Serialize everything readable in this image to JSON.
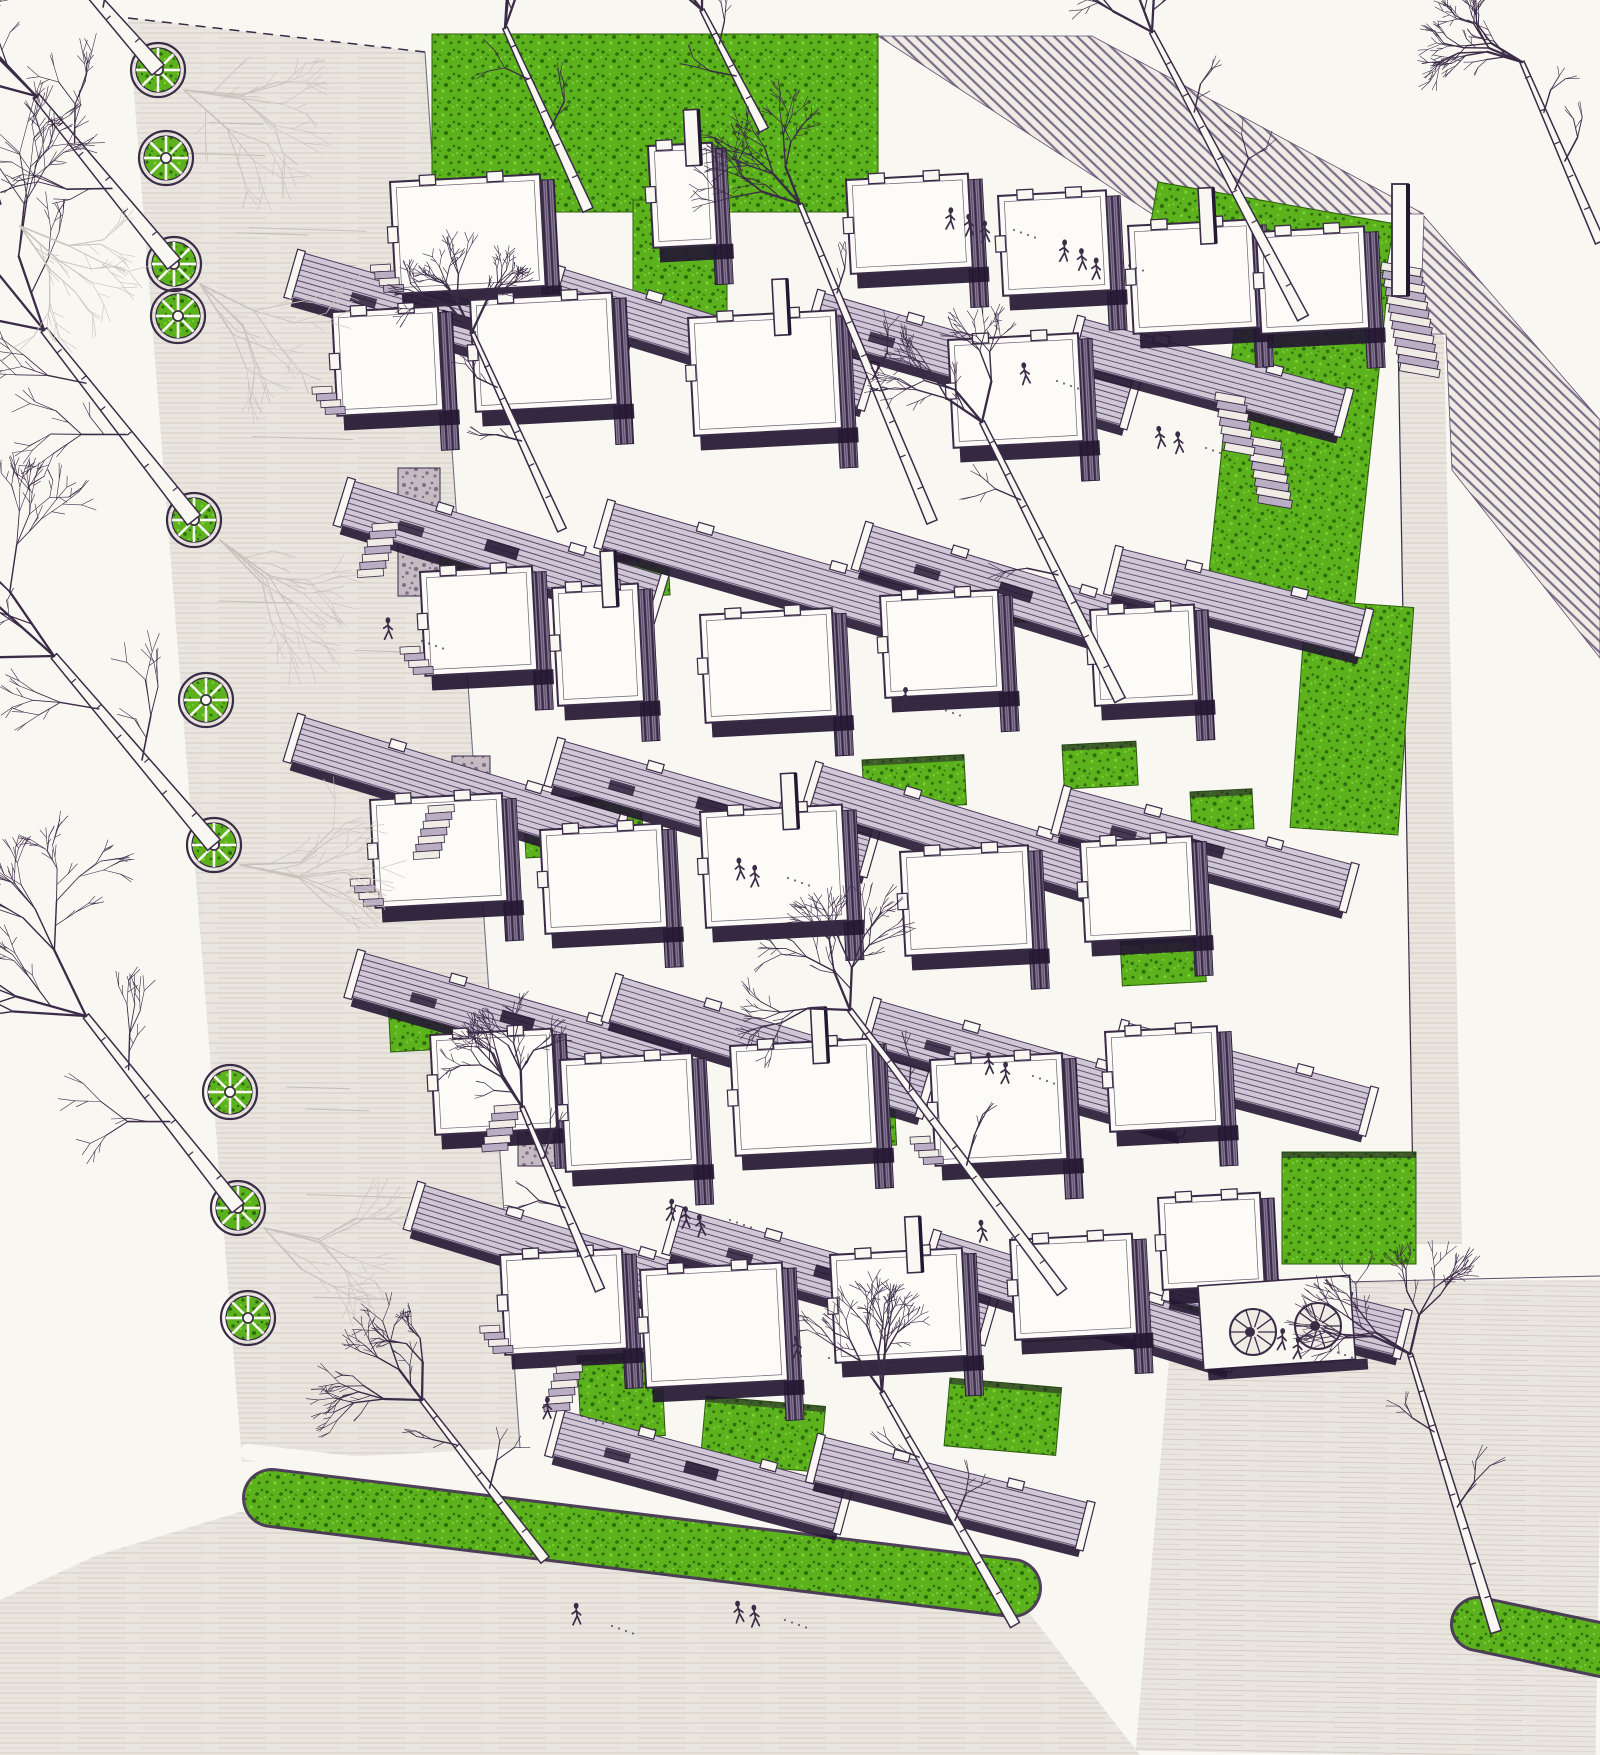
{
  "artwork": {
    "aria_label": "Pen-and-ink axonometric architectural rendering of a terraced courtyard housing estate: staggered white-roofed dwelling modules linked by hatched walkway roofs, bright green lawns and courtyard gardens, a tree-lined street with circular planters on the left, stairs descending a green slope on the right, and a curved grass verge along the bottom street.",
    "medium": "hand-drawn ink rendering with green wash",
    "visible_text": ""
  },
  "palette": {
    "paper": "#f9f7f2",
    "ink": "#3a2b47",
    "ink_soft": "#5d4b6b",
    "shadow": "#231732",
    "pavement": "#e9e6e0",
    "pavement_line": "#d4cec4",
    "pavement_accent": "#b9b0a6",
    "grass": "#5cb21c",
    "grass_dark": "#2e6a0b",
    "grass_light": "#7ed334",
    "grass_edge": "#2f5d10",
    "wall_base": "#8d7f9b",
    "walk_base": "#cfc6d6",
    "walk_line": "#4a3959",
    "stone": "#c6bbc3",
    "stone_dark": "#6b5c72",
    "hatch_bg": "#efece6",
    "hatch_line": "#7b6c88",
    "tree_pale": "#c9c2ba"
  },
  "scene": {
    "road_poly": [
      128,
      18,
      425,
      52,
      520,
      1448,
      242,
      1462
    ],
    "road_dash_edge": [
      128,
      18,
      425,
      52
    ],
    "bottom_pav_poly": [
      0,
      1755,
      0,
      1600,
      95,
      1556,
      240,
      1512,
      1030,
      1614,
      1140,
      1755
    ],
    "plaza_poly": [
      1140,
      1755,
      1168,
      1344,
      1260,
      1284,
      1600,
      1276,
      1600,
      1755
    ],
    "east_strip_poly": [
      1398,
      334,
      1444,
      334,
      1462,
      1244,
      1414,
      1244
    ],
    "hatch_top_poly": [
      878,
      36,
      1092,
      36,
      1424,
      214,
      1152,
      214
    ],
    "hatch_corner_poly": [
      1424,
      216,
      1600,
      420,
      1600,
      658,
      1452,
      470,
      1446,
      334,
      1420,
      334
    ],
    "greens": [
      [
        432,
        34,
        446,
        178,
        0,
        0
      ],
      [
        633,
        200,
        94,
        140,
        0,
        0
      ],
      [
        1158,
        182,
        240,
        72,
        10,
        0
      ],
      [
        1242,
        258,
        148,
        336,
        6,
        0
      ],
      [
        1306,
        600,
        108,
        228,
        4,
        0
      ],
      [
        420,
        550,
        128,
        46,
        -3,
        1
      ],
      [
        572,
        558,
        96,
        42,
        -3,
        1
      ],
      [
        962,
        585,
        72,
        40,
        -3,
        1
      ],
      [
        523,
        800,
        118,
        58,
        -3,
        1
      ],
      [
        862,
        760,
        102,
        50,
        -3,
        1
      ],
      [
        1062,
        745,
        74,
        44,
        -3,
        1
      ],
      [
        1190,
        792,
        62,
        40,
        -3,
        1
      ],
      [
        388,
        1000,
        94,
        52,
        -3,
        1
      ],
      [
        800,
        1098,
        94,
        52,
        -3,
        1
      ],
      [
        1120,
        940,
        84,
        46,
        -3,
        1
      ],
      [
        577,
        1356,
        84,
        84,
        -3,
        1
      ],
      [
        706,
        1396,
        120,
        66,
        5,
        1
      ],
      [
        950,
        1378,
        112,
        68,
        5,
        1
      ],
      [
        1282,
        1152,
        134,
        112,
        0,
        1
      ],
      [
        1022,
        1300,
        120,
        42,
        -3,
        1
      ],
      [
        1178,
        1298,
        150,
        44,
        -4,
        0
      ]
    ],
    "verge_main": [
      272,
      1498,
      1012,
      1588,
      54
    ],
    "verge_sidewalk": [
      248,
      1452,
      1046,
      1545,
      16
    ],
    "verge_right": [
      1478,
      1624,
      1612,
      1652,
      50
    ],
    "stones": [
      [
        398,
        468,
        42,
        128
      ],
      [
        452,
        756,
        38,
        108
      ],
      [
        518,
        1058,
        38,
        108
      ]
    ],
    "walkways": [
      [
        300,
        252,
        340,
        16,
        1
      ],
      [
        560,
        268,
        330,
        17,
        0
      ],
      [
        820,
        292,
        330,
        16,
        1
      ],
      [
        1080,
        318,
        280,
        15,
        0
      ],
      [
        350,
        480,
        330,
        17,
        1
      ],
      [
        610,
        502,
        330,
        16,
        0
      ],
      [
        868,
        524,
        320,
        17,
        1
      ],
      [
        1118,
        548,
        260,
        14,
        0
      ],
      [
        300,
        716,
        340,
        17,
        0
      ],
      [
        560,
        740,
        330,
        16,
        1
      ],
      [
        818,
        764,
        330,
        17,
        0
      ],
      [
        1066,
        788,
        300,
        15,
        1
      ],
      [
        360,
        952,
        340,
        16,
        1
      ],
      [
        618,
        976,
        330,
        17,
        0
      ],
      [
        876,
        1000,
        330,
        16,
        1
      ],
      [
        1124,
        1022,
        260,
        15,
        0
      ],
      [
        420,
        1184,
        330,
        17,
        0
      ],
      [
        678,
        1208,
        330,
        16,
        1
      ],
      [
        936,
        1232,
        320,
        17,
        0
      ],
      [
        1176,
        1254,
        240,
        14,
        0
      ],
      [
        560,
        1410,
        300,
        15,
        1
      ],
      [
        820,
        1436,
        280,
        14,
        0
      ]
    ],
    "modules": [
      [
        390,
        182,
        150,
        112,
        0,
        1
      ],
      [
        648,
        146,
        64,
        102,
        1,
        0
      ],
      [
        846,
        180,
        122,
        94,
        0,
        0
      ],
      [
        998,
        196,
        108,
        100,
        0,
        0
      ],
      [
        1128,
        226,
        124,
        108,
        1,
        0
      ],
      [
        332,
        312,
        106,
        104,
        0,
        1
      ],
      [
        470,
        300,
        142,
        112,
        0,
        0
      ],
      [
        688,
        318,
        148,
        118,
        1,
        0
      ],
      [
        948,
        340,
        130,
        108,
        0,
        0
      ],
      [
        1256,
        232,
        108,
        102,
        0,
        0
      ],
      [
        420,
        572,
        112,
        104,
        0,
        1
      ],
      [
        552,
        588,
        86,
        118,
        1,
        0
      ],
      [
        700,
        615,
        132,
        108,
        0,
        0
      ],
      [
        880,
        596,
        118,
        102,
        0,
        0
      ],
      [
        1090,
        610,
        104,
        96,
        0,
        0
      ],
      [
        370,
        800,
        132,
        108,
        0,
        1
      ],
      [
        540,
        830,
        122,
        104,
        0,
        0
      ],
      [
        700,
        812,
        142,
        116,
        1,
        0
      ],
      [
        900,
        852,
        128,
        104,
        0,
        0
      ],
      [
        1080,
        842,
        112,
        100,
        0,
        0
      ],
      [
        430,
        1035,
        122,
        100,
        0,
        0
      ],
      [
        560,
        1060,
        132,
        112,
        0,
        0
      ],
      [
        730,
        1046,
        142,
        110,
        1,
        0
      ],
      [
        930,
        1060,
        132,
        106,
        0,
        1
      ],
      [
        1105,
        1032,
        112,
        100,
        0,
        0
      ],
      [
        500,
        1255,
        122,
        100,
        0,
        1
      ],
      [
        640,
        1270,
        142,
        118,
        0,
        0
      ],
      [
        830,
        1255,
        132,
        108,
        1,
        0
      ],
      [
        1010,
        1240,
        122,
        100,
        0,
        0
      ],
      [
        1158,
        1198,
        102,
        92,
        0,
        0
      ]
    ],
    "se_tile": [
      1198,
      1286,
      152,
      84
    ],
    "se_circles": [
      [
        1253,
        1332
      ],
      [
        1318,
        1326
      ]
    ],
    "west_stairs": [
      [
        372,
        524,
        7
      ],
      [
        428,
        806,
        7
      ],
      [
        494,
        1106,
        6
      ],
      [
        556,
        1366,
        6
      ]
    ],
    "right_stairs": [
      [
        1382,
        262,
        13,
        40
      ],
      [
        1248,
        436,
        8,
        34
      ],
      [
        1216,
        392,
        7,
        30
      ]
    ],
    "fins": [
      [
        1392,
        184,
        16,
        112
      ]
    ],
    "planters": [
      [
        158,
        70
      ],
      [
        166,
        158
      ],
      [
        174,
        264
      ],
      [
        178,
        316
      ],
      [
        194,
        520
      ],
      [
        206,
        700
      ],
      [
        214,
        845
      ],
      [
        230,
        1092
      ],
      [
        238,
        1208
      ],
      [
        248,
        1318
      ]
    ],
    "figures": [
      [
        952,
        222,
        3
      ],
      [
        1060,
        255,
        3
      ],
      [
        1023,
        373,
        1
      ],
      [
        1158,
        440,
        2
      ],
      [
        388,
        633,
        1
      ],
      [
        668,
        1212,
        3
      ],
      [
        985,
        1068,
        2
      ],
      [
        978,
        1230,
        1
      ],
      [
        578,
        1618,
        1
      ],
      [
        737,
        1612,
        2
      ],
      [
        1283,
        1342,
        2
      ],
      [
        548,
        1408,
        1
      ],
      [
        795,
        1350,
        1
      ],
      [
        740,
        870,
        2
      ],
      [
        905,
        700,
        1
      ]
    ],
    "trees": [
      [
        158,
        70,
        36,
        -70,
        1.45,
        101,
        1
      ],
      [
        174,
        264,
        36,
        96,
        1.5,
        103,
        1
      ],
      [
        194,
        520,
        44,
        330,
        1.5,
        107,
        1
      ],
      [
        214,
        845,
        54,
        656,
        1.5,
        109,
        1
      ],
      [
        238,
        1208,
        86,
        1016,
        1.4,
        113,
        1
      ],
      [
        -6,
        206,
        -60,
        30,
        1.3,
        127,
        1
      ],
      [
        588,
        210,
        505,
        28,
        1.0,
        3,
        0
      ],
      [
        764,
        130,
        702,
        10,
        0.9,
        5,
        0
      ],
      [
        1303,
        318,
        1152,
        32,
        1.1,
        7,
        0
      ],
      [
        932,
        522,
        800,
        204,
        1.0,
        9,
        0
      ],
      [
        562,
        530,
        472,
        332,
        0.85,
        13,
        0
      ],
      [
        1120,
        700,
        982,
        422,
        1.05,
        17,
        0
      ],
      [
        1062,
        1292,
        850,
        1010,
        1.05,
        19,
        0
      ],
      [
        600,
        1290,
        522,
        1107,
        0.9,
        21,
        0
      ],
      [
        1015,
        1625,
        882,
        1392,
        0.95,
        29,
        0
      ],
      [
        545,
        1560,
        422,
        1400,
        0.95,
        37,
        0
      ],
      [
        1496,
        1632,
        1410,
        1354,
        1.0,
        43,
        0
      ],
      [
        1600,
        242,
        1522,
        62,
        0.9,
        47,
        0
      ]
    ]
  }
}
